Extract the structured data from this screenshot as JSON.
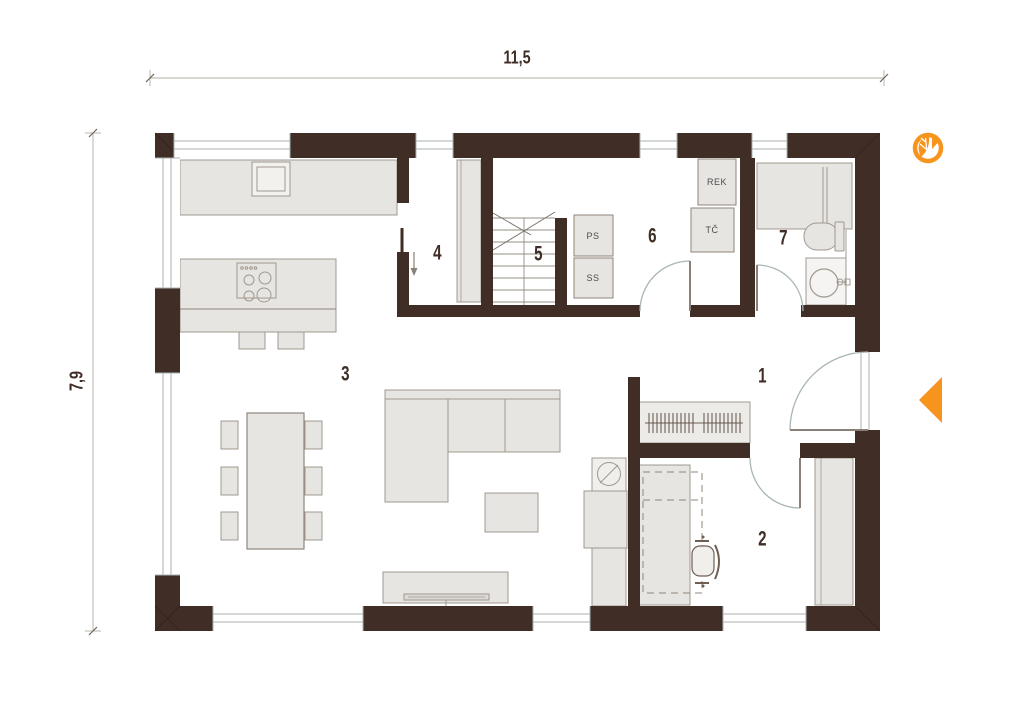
{
  "dimensions": {
    "width": "11,5",
    "height": "7,9"
  },
  "rooms": [
    {
      "number": "1"
    },
    {
      "number": "2"
    },
    {
      "number": "3"
    },
    {
      "number": "4"
    },
    {
      "number": "5"
    },
    {
      "number": "6"
    },
    {
      "number": "7"
    }
  ],
  "equipment": {
    "rek": "REK",
    "tc": "TČ",
    "ps": "PS",
    "ss": "SS"
  },
  "colors": {
    "wall": "#3f2d26",
    "furniture_fill": "#e7e5e1",
    "appliance_fill": "#f0efec",
    "furniture_stroke": "#a09890",
    "window_line": "#aab3b1",
    "door_arc": "#a9b6b4",
    "accent_orange": "#f7941d",
    "label_text": "#3f2d26",
    "equipment_text": "#4c4c4c"
  },
  "icons": {
    "logo": "leaf-in-circle-icon",
    "entrance": "entrance-arrow-icon"
  }
}
